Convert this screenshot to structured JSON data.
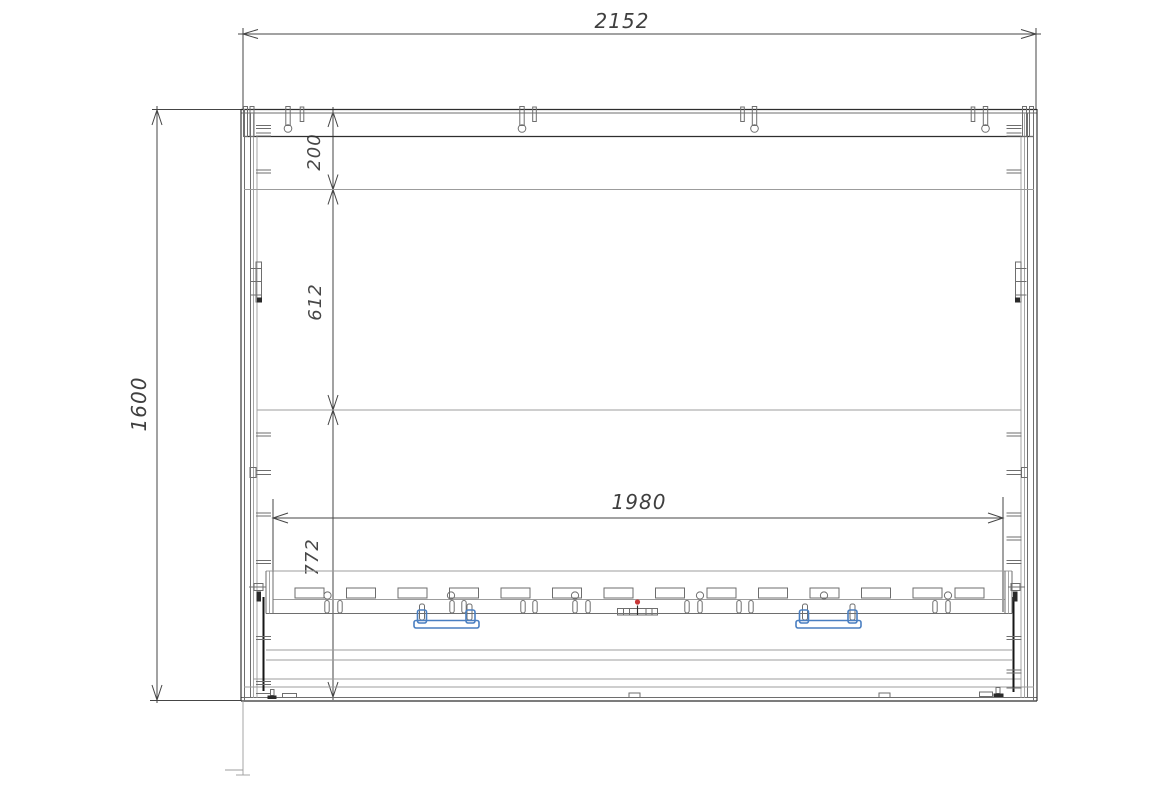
{
  "dims": {
    "overall_width": "2152",
    "overall_height": "1600",
    "top_offset": "200",
    "upper_section": "612",
    "lower_section": "772",
    "inner_platform_width": "1980"
  },
  "colors": {
    "line_dark": "#2e2e2e",
    "line_light": "#9c9c9c",
    "dim_text": "#3f3f3f",
    "accent_blue": "#4a7fc1",
    "accent_red": "#c83737",
    "background": "#ffffff"
  }
}
